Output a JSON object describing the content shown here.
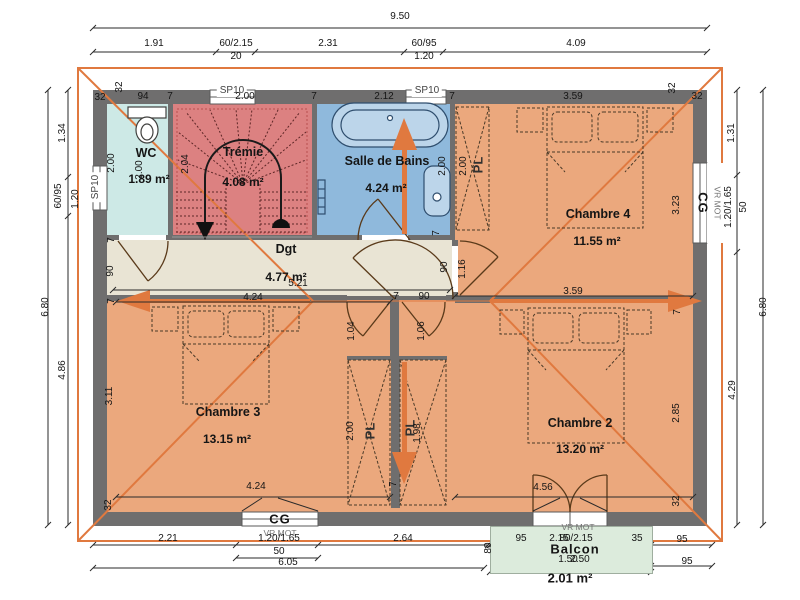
{
  "meta": {
    "drawing_type": "floor plan"
  },
  "colors": {
    "wall": "#6F6E6E",
    "roof_line": "#E0793F",
    "arrow": "#E0793F",
    "room_bedroom": "#EBA87D",
    "room_stair": "#DC8181",
    "room_bath": "#8FB9DC",
    "room_wc": "#CDE9E6",
    "room_hall": "#E9E4D4",
    "balcony": "#DCEBDC",
    "dim_text": "#151515"
  },
  "rooms": [
    {
      "name": "WC",
      "area": "1.89 m²"
    },
    {
      "name": "Trémie",
      "area": "4.08 m²"
    },
    {
      "name": "Salle de Bains",
      "area": "4.24 m²"
    },
    {
      "name": "Dgt",
      "area": "4.77 m²"
    },
    {
      "name": "Chambre 4",
      "area": "11.55 m²"
    },
    {
      "name": "Chambre 3",
      "area": "13.15 m²"
    },
    {
      "name": "Chambre 2",
      "area": "13.20 m²"
    },
    {
      "name": "Balcon",
      "area": "2.01 m²"
    }
  ],
  "labels": [
    [
      "9.50",
      400,
      17,
      ""
    ],
    [
      "1.91",
      154,
      44,
      ""
    ],
    [
      "60/2.15",
      236,
      44,
      ""
    ],
    [
      "2.31",
      328,
      44,
      ""
    ],
    [
      "60/95",
      424,
      44,
      ""
    ],
    [
      "4.09",
      576,
      44,
      ""
    ],
    [
      "20",
      236,
      57,
      ""
    ],
    [
      "1.20",
      424,
      57,
      ""
    ],
    [
      "SP10",
      232,
      91,
      "box",
      "window-label-sp10"
    ],
    [
      "SP10",
      427,
      91,
      "box",
      "window-label-sp10"
    ],
    [
      "32",
      100,
      98,
      ""
    ],
    [
      "32",
      120,
      87,
      "r"
    ],
    [
      "94",
      143,
      97,
      ""
    ],
    [
      "7",
      170,
      97,
      ""
    ],
    [
      "2.00",
      245,
      97,
      ""
    ],
    [
      "7",
      314,
      97,
      ""
    ],
    [
      "2.12",
      384,
      97,
      ""
    ],
    [
      "7",
      452,
      97,
      ""
    ],
    [
      "3.59",
      573,
      97,
      ""
    ],
    [
      "32",
      673,
      88,
      "r"
    ],
    [
      "32",
      697,
      97,
      ""
    ],
    [
      "6.80",
      46,
      307,
      "r"
    ],
    [
      "1.34",
      63,
      133,
      "r"
    ],
    [
      "60/95",
      59,
      196,
      "r"
    ],
    [
      "1.20",
      76,
      199,
      "r"
    ],
    [
      "4.86",
      63,
      370,
      "r"
    ],
    [
      "SP10",
      96,
      187,
      "box r",
      "window-label-sp10"
    ],
    [
      "2.00",
      112,
      163,
      "r"
    ],
    [
      "7",
      112,
      240,
      "r"
    ],
    [
      "90",
      111,
      271,
      "r"
    ],
    [
      "7",
      112,
      301,
      "r"
    ],
    [
      "3.11",
      110,
      396,
      "r"
    ],
    [
      "32",
      109,
      505,
      "r"
    ],
    [
      "6.80",
      764,
      307,
      "r"
    ],
    [
      "1.31",
      732,
      133,
      "r"
    ],
    [
      "1.20/1.65",
      729,
      207,
      "r"
    ],
    [
      "50",
      744,
      207,
      "r"
    ],
    [
      "4.29",
      733,
      390,
      "r"
    ],
    [
      "CG",
      703,
      203,
      "cg r90",
      "window-label-cg"
    ],
    [
      "VR MOT",
      717,
      203,
      "sm r90",
      "window-label-vrmot"
    ],
    [
      "3.23",
      677,
      205,
      "r"
    ],
    [
      "7",
      678,
      312,
      "r"
    ],
    [
      "2.85",
      677,
      413,
      "r"
    ],
    [
      "32",
      677,
      501,
      "r"
    ],
    [
      "CG",
      280,
      519,
      "cg",
      "window-label-cg"
    ],
    [
      "VR MOT",
      280,
      533,
      "sm",
      "window-label-vrmot"
    ],
    [
      "2.21",
      168,
      539,
      ""
    ],
    [
      "1.20/1.65",
      279,
      539,
      ""
    ],
    [
      "50",
      279,
      552,
      ""
    ],
    [
      "2.64",
      403,
      539,
      ""
    ],
    [
      "80",
      489,
      548,
      "r"
    ],
    [
      "95",
      521,
      539,
      ""
    ],
    [
      "2.15",
      559,
      539,
      ""
    ],
    [
      "80/2.15",
      576,
      539,
      ""
    ],
    [
      "35",
      637,
      539,
      ""
    ],
    [
      "95",
      682,
      540,
      ""
    ],
    [
      "6.05",
      288,
      563,
      ""
    ],
    [
      "VR MOT",
      578,
      527,
      "sm",
      "window-label-vrmot"
    ],
    [
      "Balcon",
      575,
      549,
      "cg",
      "room-label-balcon"
    ],
    [
      "2.50",
      580,
      560,
      ""
    ],
    [
      "1.50",
      568,
      560,
      ""
    ],
    [
      "95",
      687,
      562,
      ""
    ],
    [
      "2.01 m²",
      570,
      578,
      "big",
      "room-area-balcon"
    ],
    [
      "WC",
      146,
      153,
      "rm",
      "room-label-wc"
    ],
    [
      "1.89 m²",
      149,
      179,
      "ar",
      "room-area-wc"
    ],
    [
      "Trémie",
      243,
      152,
      "rm",
      "room-label-tremie"
    ],
    [
      "4.08 m²",
      243,
      182,
      "ar",
      "room-area-tremie"
    ],
    [
      "Salle de Bains",
      387,
      161,
      "rm",
      "room-label-sdb"
    ],
    [
      "4.24 m²",
      386,
      188,
      "ar",
      "room-area-sdb"
    ],
    [
      "Chambre 4",
      598,
      214,
      "rm",
      "room-label-chambre4"
    ],
    [
      "11.55 m²",
      597,
      241,
      "ar",
      "room-area-chambre4"
    ],
    [
      "Dgt",
      286,
      249,
      "rm",
      "room-label-dgt"
    ],
    [
      "4.77 m²",
      286,
      277,
      "ar",
      "room-area-dgt"
    ],
    [
      "5.21",
      298,
      284,
      ""
    ],
    [
      "Chambre 3",
      228,
      412,
      "rm",
      "room-label-chambre3"
    ],
    [
      "13.15 m²",
      227,
      439,
      "ar",
      "room-area-chambre3"
    ],
    [
      "Chambre 2",
      580,
      423,
      "rm",
      "room-label-chambre2"
    ],
    [
      "13.20 m²",
      580,
      449,
      "ar",
      "room-area-chambre2"
    ],
    [
      "2.00",
      140,
      170,
      "r"
    ],
    [
      "2.04",
      186,
      164,
      "r"
    ],
    [
      "2.00",
      443,
      166,
      "r"
    ],
    [
      "2.00",
      464,
      166,
      "r"
    ],
    [
      "PL",
      478,
      165,
      "pl r",
      "closet-label-pl"
    ],
    [
      "1.16",
      463,
      269,
      "r"
    ],
    [
      "90",
      445,
      267,
      "r"
    ],
    [
      "7",
      437,
      233,
      "r"
    ],
    [
      "3.59",
      573,
      292,
      ""
    ],
    [
      "4.24",
      253,
      298,
      ""
    ],
    [
      "7",
      396,
      297,
      ""
    ],
    [
      "90",
      424,
      297,
      ""
    ],
    [
      "1.04",
      352,
      331,
      "r"
    ],
    [
      "1.06",
      422,
      331,
      "r"
    ],
    [
      "7",
      394,
      484,
      "r"
    ],
    [
      "2.00",
      351,
      431,
      "r"
    ],
    [
      "PL",
      370,
      431,
      "pl r",
      "closet-label-pl"
    ],
    [
      "PL",
      410,
      428,
      "pl r",
      "closet-label-pl"
    ],
    [
      "1.98",
      418,
      433,
      "r"
    ],
    [
      "4.24",
      256,
      487,
      ""
    ],
    [
      "4.56",
      543,
      488,
      ""
    ]
  ]
}
